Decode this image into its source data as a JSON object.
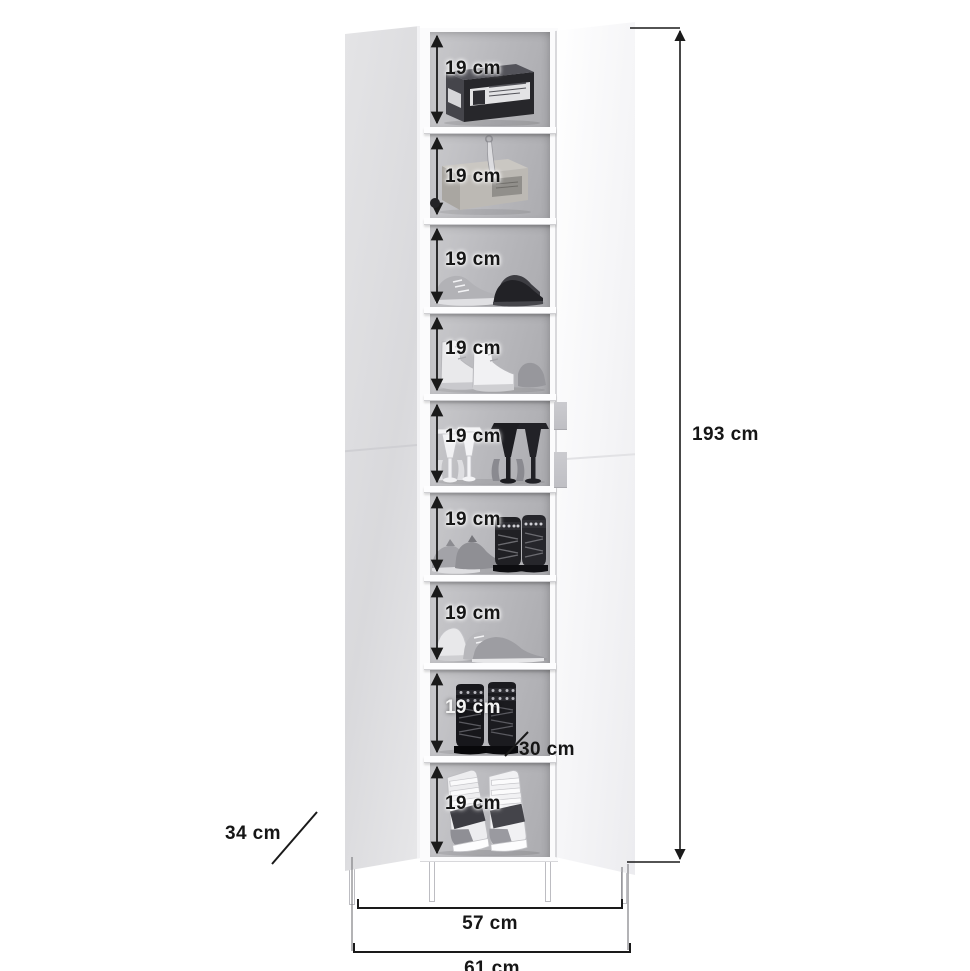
{
  "diagram": {
    "name": "shoe cabinet dimension diagram",
    "unit": "cm",
    "line_color": "#1a1a1a",
    "background_color": "#ffffff"
  },
  "cabinet": {
    "description": "tall white two-door shoe cabinet shown with both doors open and nine shelf compartments filled with shoes",
    "body_color": "#fbfbfc",
    "left_door_color": "#dedee1",
    "right_door_color": "#f5f5f7",
    "interior_color": "#b9b9bd",
    "shelf_count": 9
  },
  "shelves": [
    {
      "label": "19 cm",
      "height_cm": 19,
      "icon": "shoe-box-icon"
    },
    {
      "label": "19 cm",
      "height_cm": 19,
      "icon": "cardboard-box-shoehorn-icon"
    },
    {
      "label": "19 cm",
      "height_cm": 19,
      "icon": "sneaker-and-dress-shoes-icon"
    },
    {
      "label": "19 cm",
      "height_cm": 19,
      "icon": "high-top-sneakers-icon"
    },
    {
      "label": "19 cm",
      "height_cm": 19,
      "icon": "high-heels-icon"
    },
    {
      "label": "19 cm",
      "height_cm": 19,
      "icon": "sneakers-and-studded-boots-icon"
    },
    {
      "label": "19 cm",
      "height_cm": 19,
      "icon": "running-sneakers-icon"
    },
    {
      "label": "19 cm",
      "height_cm": 19,
      "icon": "lace-up-boots-icon"
    },
    {
      "label": "19 cm",
      "height_cm": 19,
      "icon": "wedge-sneakers-icon"
    }
  ],
  "measurements": {
    "total_height": {
      "text": "193 cm",
      "value_cm": 193
    },
    "inner_width": {
      "text": "57 cm",
      "value_cm": 57
    },
    "outer_width": {
      "text": "61 cm",
      "value_cm": 61
    },
    "depth": {
      "text": "34 cm",
      "value_cm": 34
    },
    "shelf_depth": {
      "text": "30 cm",
      "value_cm": 30
    }
  }
}
